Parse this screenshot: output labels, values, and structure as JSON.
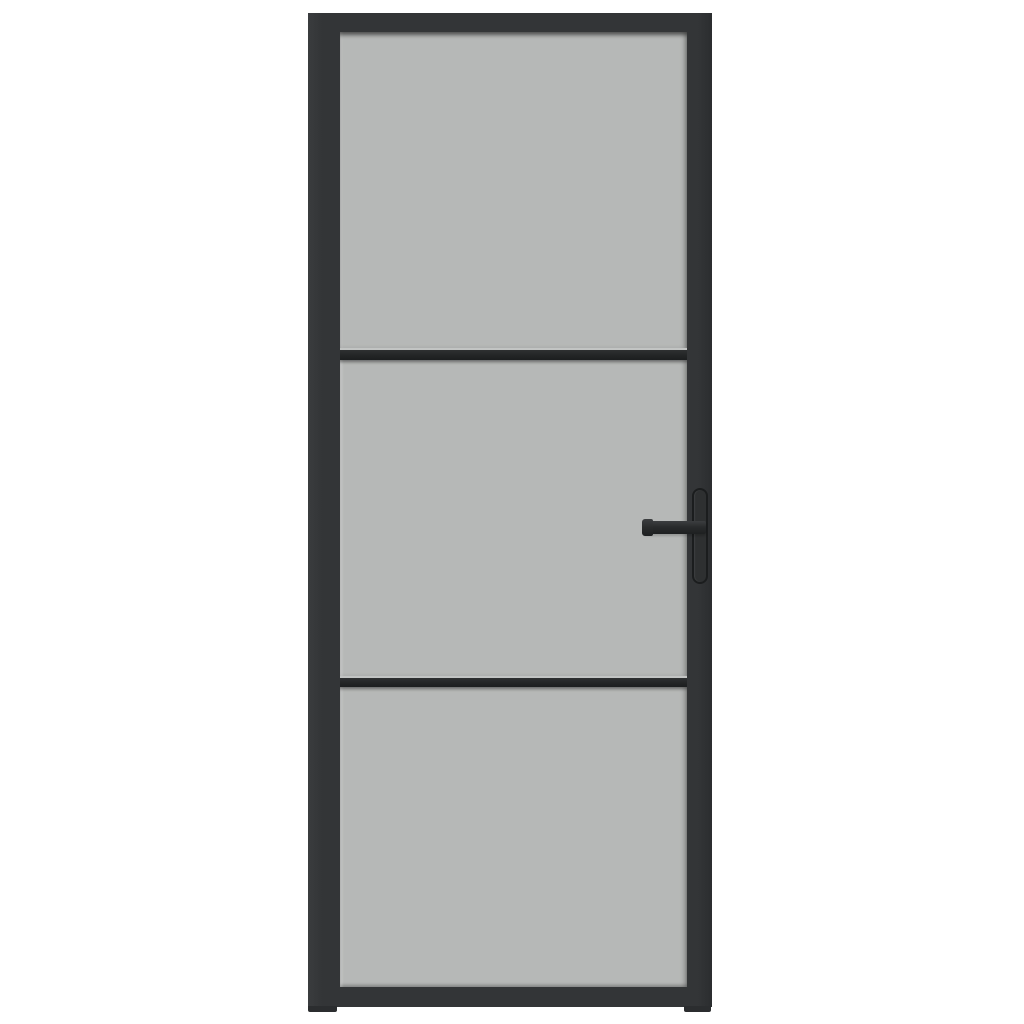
{
  "scene": {
    "description": "Product photograph of a black-framed interior glass door with three frosted glass panels, two horizontal glazing bars and a matte black lever handle on the right stile, centered on a plain white background",
    "object": "interior-glass-door",
    "panel_count": 3,
    "glazing_bar_count": 2,
    "handle_side": "right",
    "visible_text": ""
  },
  "colors": {
    "background": "#ffffff",
    "frame": "#333537",
    "frame_light": "#3a3c3e",
    "frame_dark": "#2b2d2f",
    "glass": "#b6b8b7",
    "divider": "#232526",
    "divider_light": "#2e3031",
    "divider_dark": "#1c1e1f",
    "divider_highlight": "#c2c4c3",
    "handle": "#292b2c",
    "handle_light": "#3c3e40",
    "handle_dark": "#1e2021",
    "handle_plate": "#2e3031",
    "handle_plate_border": "#1b1d1e"
  },
  "door": {
    "panels": [
      {
        "id": "top"
      },
      {
        "id": "middle"
      },
      {
        "id": "bottom"
      }
    ],
    "bars": [
      {
        "id": "upper"
      },
      {
        "id": "lower"
      }
    ]
  }
}
